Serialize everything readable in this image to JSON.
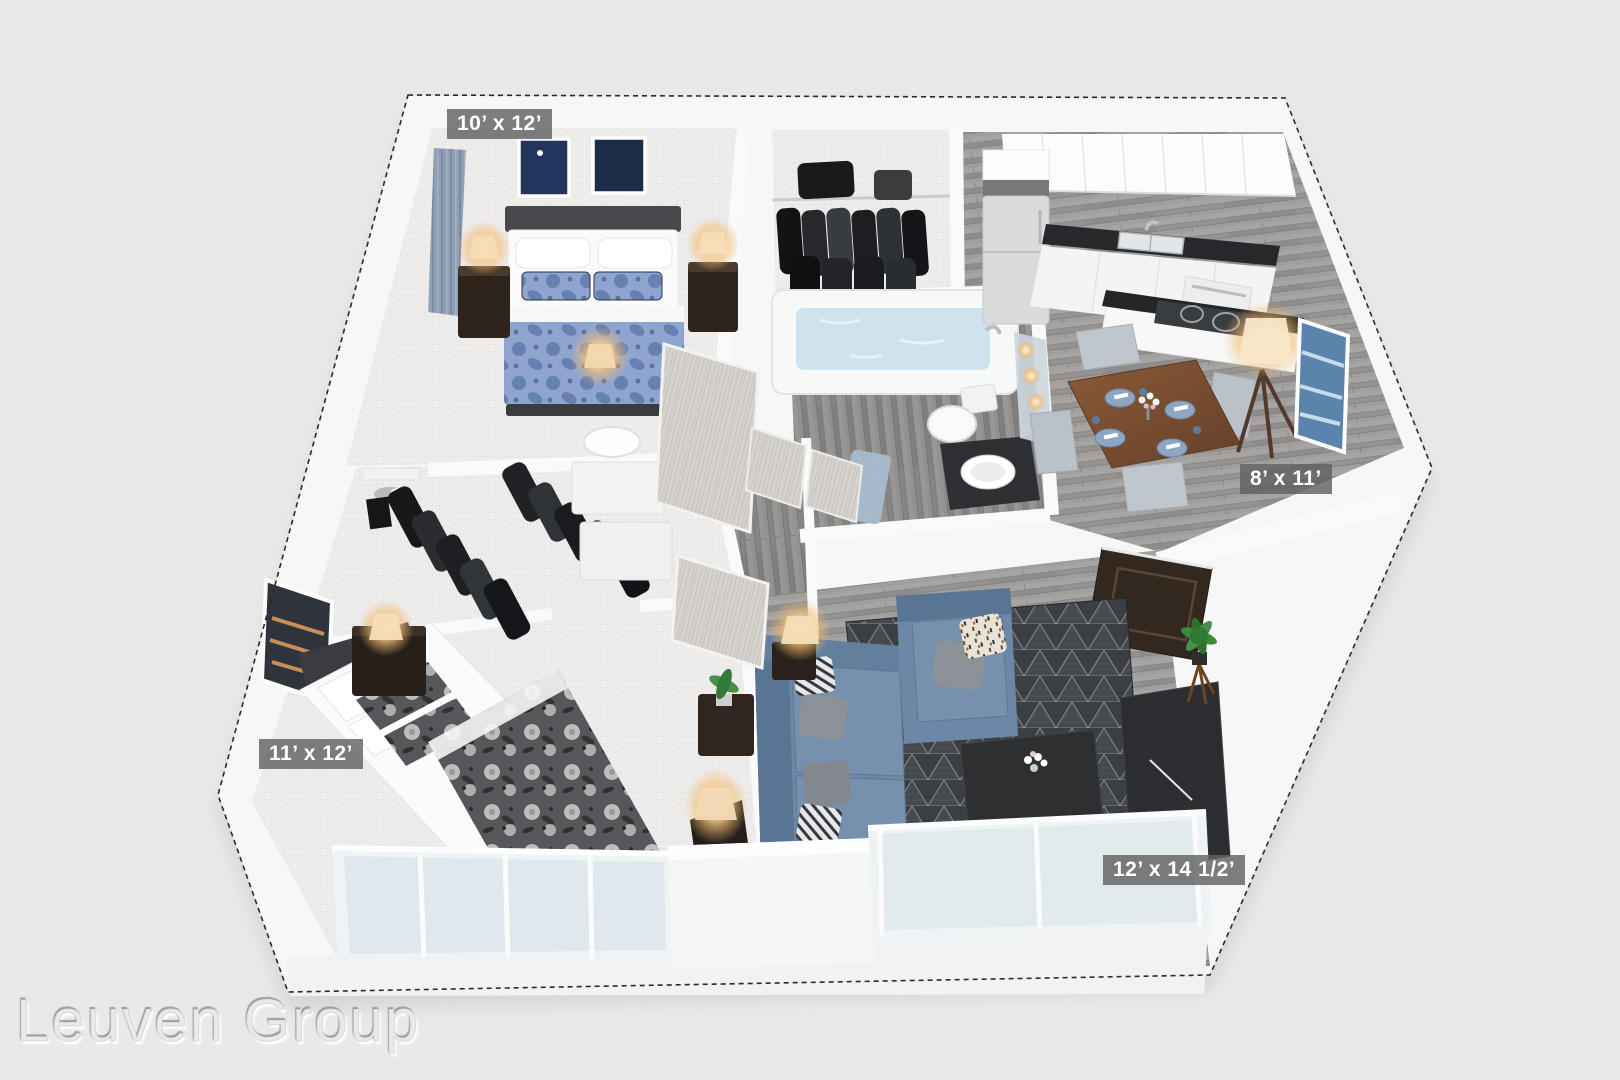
{
  "app": {
    "type": "floor-plan-rendering",
    "view": "3d-dollhouse-top-perspective"
  },
  "watermark": {
    "text": "Leuven Group"
  },
  "rooms": [
    {
      "id": "bedroom-1",
      "dimensions": "10’ x 12’"
    },
    {
      "id": "dining-area",
      "dimensions": "8’ x 11’"
    },
    {
      "id": "bedroom-2",
      "dimensions": "11’ x 12’"
    },
    {
      "id": "living-room",
      "dimensions": "12’ x 14 1/2’"
    }
  ],
  "palette": {
    "background": "#e9e9ea",
    "walls": "#f7f7f7",
    "wood_floor": "#9d9c9a",
    "carpet": "#eeedec",
    "sofa_blue": "#6d87a6",
    "rug_dark": "#3b3e42",
    "counter_black": "#26282b",
    "lamp_glow": "#fdd9a0",
    "label_bg": "rgba(98,98,98,0.82)",
    "label_text": "#ffffff"
  }
}
